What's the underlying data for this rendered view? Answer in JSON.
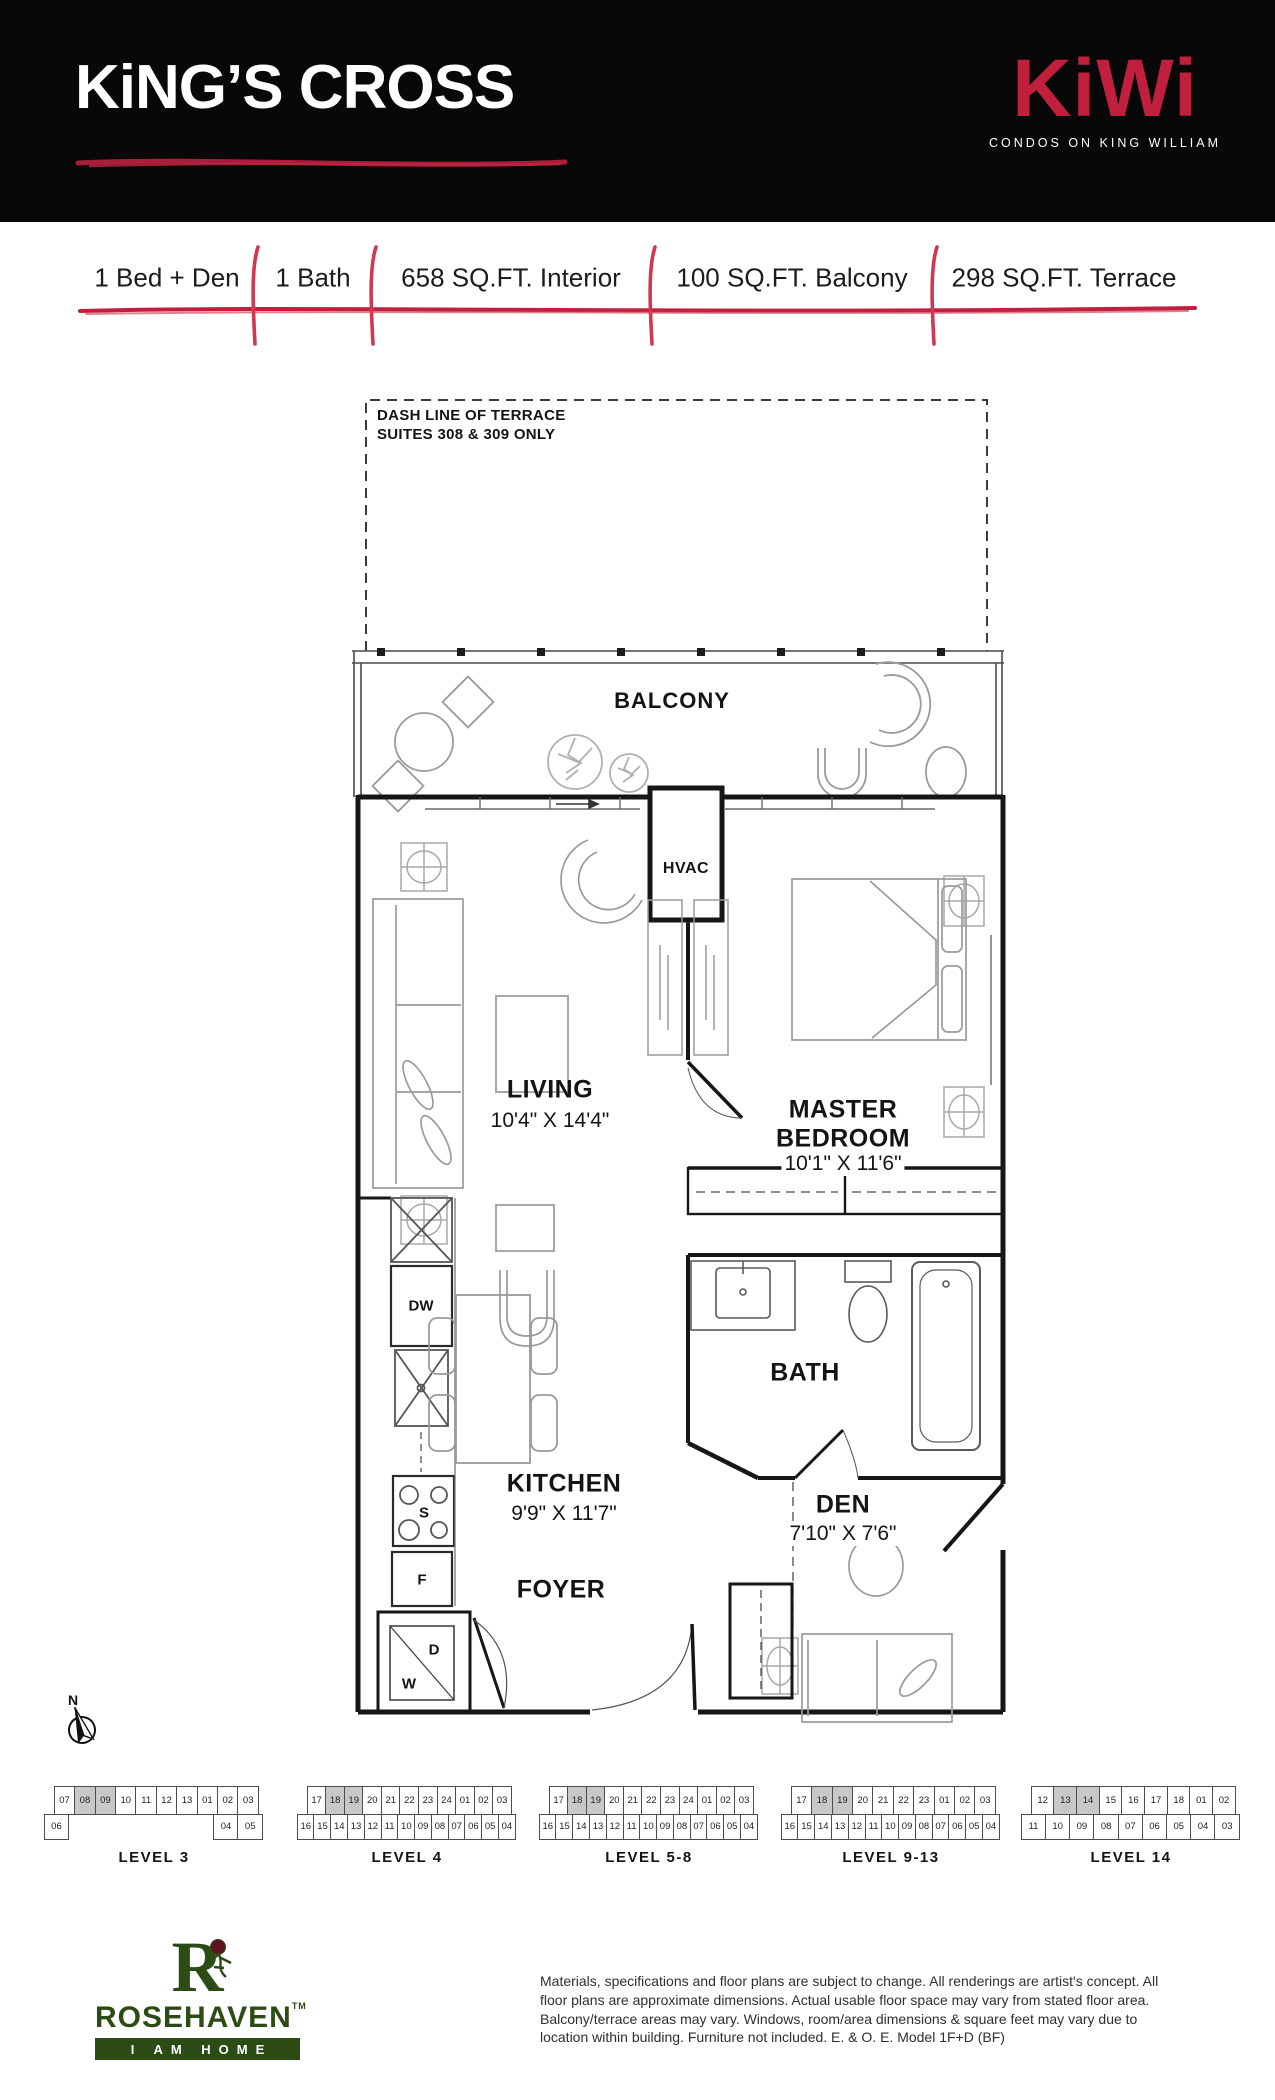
{
  "header": {
    "title": "KiNG’S CROSS",
    "brand": "KiWi",
    "brand_tagline": "CONDOS ON KING WILLIAM"
  },
  "specs": {
    "items": [
      "1 Bed + Den",
      "1 Bath",
      "658 SQ.FT. Interior",
      "100 SQ.FT. Balcony",
      "298 SQ.FT. Terrace"
    ]
  },
  "floorplan": {
    "terrace_note_line1": "DASH LINE OF TERRACE",
    "terrace_note_line2": "SUITES 308 & 309 ONLY",
    "compass_label": "N",
    "rooms": {
      "balcony": {
        "name": "BALCONY"
      },
      "living": {
        "name": "LIVING",
        "dims": "10'4\" X 14'4\""
      },
      "master": {
        "name1": "MASTER",
        "name2": "BEDROOM",
        "dims": "10'1\" X 11'6\""
      },
      "bath": {
        "name": "BATH"
      },
      "kitchen": {
        "name": "KITCHEN",
        "dims": "9'9\" X 11'7\""
      },
      "den": {
        "name": "DEN",
        "dims": "7'10\" X 7'6\""
      },
      "foyer": {
        "name": "FOYER"
      },
      "hvac": {
        "name": "HVAC"
      }
    },
    "appliances": {
      "dishwasher": "DW",
      "stove": "S",
      "fridge": "F",
      "dryer": "D",
      "washer": "W"
    }
  },
  "keyplans": {
    "levels": [
      {
        "label": "LEVEL 3",
        "top": [
          "07",
          "08",
          "09",
          "10",
          "11",
          "12",
          "13",
          "01",
          "02",
          "03"
        ],
        "bottom": [
          "06",
          "",
          "",
          "",
          "",
          "",
          "",
          "04",
          "05"
        ],
        "highlighted": [
          "08",
          "09"
        ]
      },
      {
        "label": "LEVEL 4",
        "top": [
          "17",
          "18",
          "19",
          "20",
          "21",
          "22",
          "23",
          "24",
          "01",
          "02",
          "03"
        ],
        "bottom": [
          "16",
          "15",
          "14",
          "13",
          "12",
          "11",
          "10",
          "09",
          "08",
          "07",
          "06",
          "05",
          "04"
        ],
        "highlighted": [
          "18",
          "19"
        ]
      },
      {
        "label": "LEVEL 5-8",
        "top": [
          "17",
          "18",
          "19",
          "20",
          "21",
          "22",
          "23",
          "24",
          "01",
          "02",
          "03"
        ],
        "bottom": [
          "16",
          "15",
          "14",
          "13",
          "12",
          "11",
          "10",
          "09",
          "08",
          "07",
          "06",
          "05",
          "04"
        ],
        "highlighted": [
          "18",
          "19"
        ]
      },
      {
        "label": "LEVEL 9-13",
        "top": [
          "17",
          "18",
          "19",
          "20",
          "21",
          "22",
          "23",
          "01",
          "02",
          "03"
        ],
        "bottom": [
          "16",
          "15",
          "14",
          "13",
          "12",
          "11",
          "10",
          "09",
          "08",
          "07",
          "06",
          "05",
          "04"
        ],
        "highlighted": [
          "18",
          "19"
        ]
      },
      {
        "label": "LEVEL 14",
        "top": [
          "12",
          "13",
          "14",
          "15",
          "16",
          "17",
          "18",
          "01",
          "02"
        ],
        "bottom": [
          "11",
          "10",
          "09",
          "08",
          "07",
          "06",
          "05",
          "04",
          "03"
        ],
        "highlighted": [
          "13",
          "14"
        ]
      }
    ]
  },
  "footer": {
    "builder": {
      "monogram": "R",
      "name": "ROSEHAVEN",
      "tm": "TM",
      "tagline": "I AM HOME"
    },
    "disclaimer": "Materials, specifications and floor plans are subject to change. All renderings are artist's concept. All floor plans are approximate dimensions. Actual usable floor space may vary from stated floor area. Balcony/terrace areas may vary. Windows, room/area dimensions & square feet may vary due to location within building. Furniture not included. E. & O. E. Model 1F+D (BF)"
  },
  "colors": {
    "brand_red": "#c0203e",
    "rosehaven_green": "#2c4b15",
    "keyplan_highlight": "#c8c8c8"
  }
}
